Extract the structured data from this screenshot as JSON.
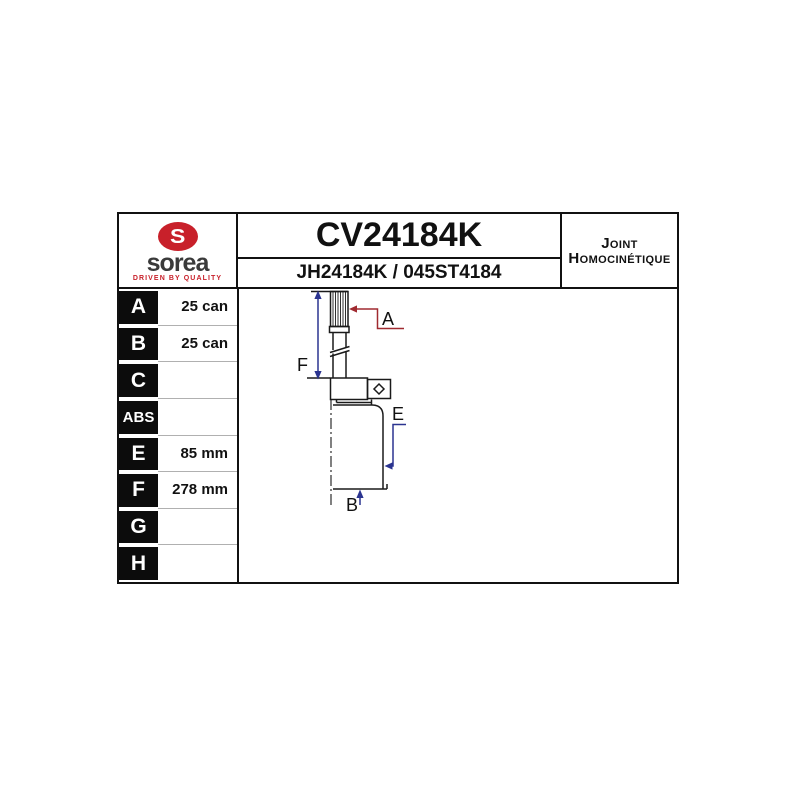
{
  "header": {
    "part_number": "CV24184K",
    "reference_numbers": "JH24184K / 045ST4184",
    "product_type_line1": "Joint",
    "product_type_line2": "Homocinétique",
    "logo": {
      "brand": "sorea",
      "monogram": "S",
      "tagline": "DRIVEN BY QUALITY"
    }
  },
  "spec_table": {
    "rows": [
      {
        "label": "A",
        "value": "25 can"
      },
      {
        "label": "B",
        "value": "25 can"
      },
      {
        "label": "C",
        "value": ""
      },
      {
        "label": "ABS",
        "value": ""
      },
      {
        "label": "E",
        "value": "85 mm"
      },
      {
        "label": "F",
        "value": "278 mm"
      },
      {
        "label": "G",
        "value": ""
      },
      {
        "label": "H",
        "value": ""
      }
    ]
  },
  "diagram": {
    "dimension_labels": {
      "A": "A",
      "B": "B",
      "E": "E",
      "F": "F"
    },
    "colors": {
      "outline": "#1a1a1a",
      "dimension_blue": "#2b3490",
      "dimension_red": "#a02a30"
    }
  },
  "brand_colors": {
    "logo_red": "#c8202a",
    "logo_text_gray": "#3a3a3a"
  }
}
